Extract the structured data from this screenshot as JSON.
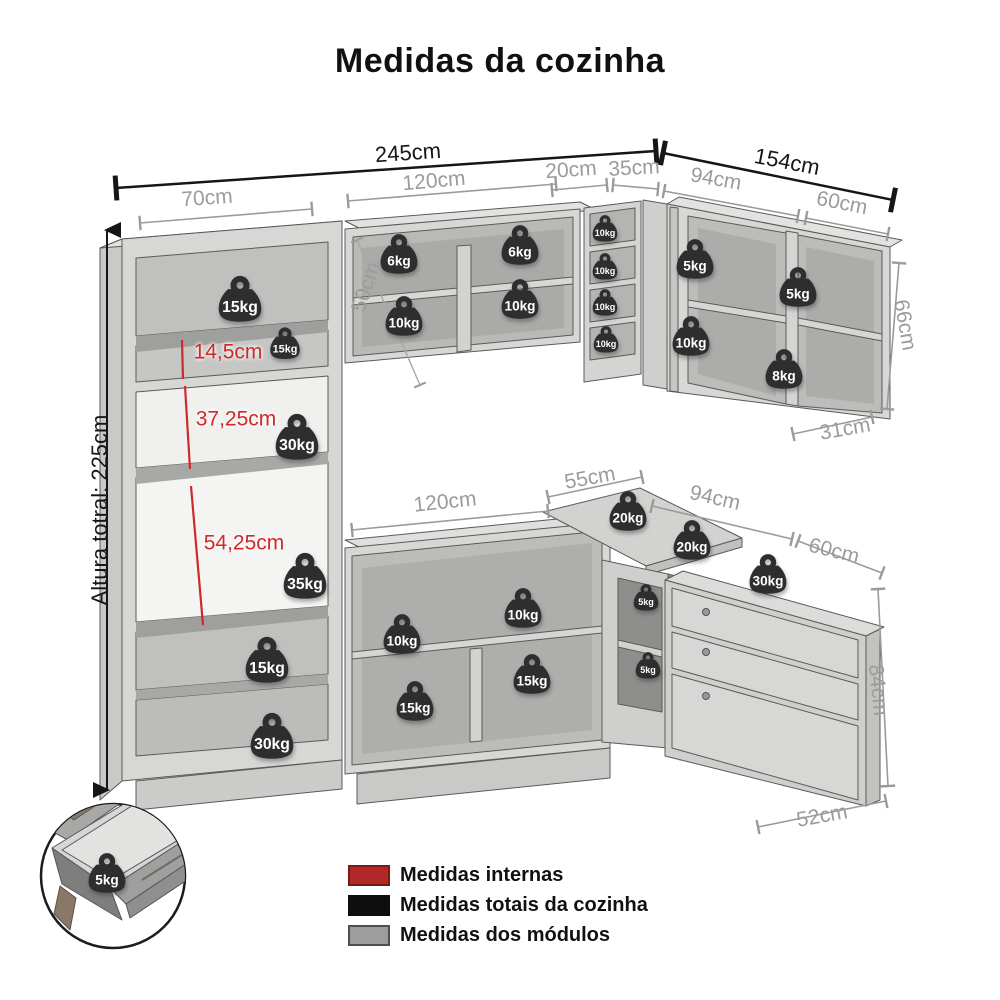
{
  "title": "Medidas da cozinha",
  "legend": {
    "items": [
      {
        "label": "Medidas internas",
        "color": "#b22828",
        "border": "#7a1818"
      },
      {
        "label": "Medidas totais da cozinha",
        "color": "#0e0e0e",
        "border": "#0e0e0e"
      },
      {
        "label": "Medidas dos módulos",
        "color": "#9d9d9d",
        "border": "#4f4f4f"
      }
    ]
  },
  "colors": {
    "dim_total": "#161616",
    "dim_module": "#9b9c99",
    "dim_internal": "#cf2a2a",
    "weight_badge": "#2e2e2e",
    "weight_text": "#ffffff",
    "cabinet_light": "#d7d8d5",
    "cabinet_shadow": "#aeafac"
  },
  "dimension_labels": [
    {
      "text": "245cm",
      "x": 408,
      "y": 153,
      "rot": -4,
      "t": "total"
    },
    {
      "text": "154cm",
      "x": 787,
      "y": 162,
      "rot": 11,
      "t": "total"
    },
    {
      "text": "Altura totral: 225cm",
      "x": 100,
      "y": 510,
      "rot": -90,
      "t": "total"
    },
    {
      "text": "70cm",
      "x": 207,
      "y": 198,
      "rot": -4,
      "t": "module"
    },
    {
      "text": "120cm",
      "x": 434,
      "y": 181,
      "rot": -5,
      "t": "module"
    },
    {
      "text": "20cm",
      "x": 571,
      "y": 170,
      "rot": -4,
      "t": "module"
    },
    {
      "text": "35cm",
      "x": 634,
      "y": 168,
      "rot": -3,
      "t": "module"
    },
    {
      "text": "94cm",
      "x": 716,
      "y": 179,
      "rot": 10,
      "t": "module"
    },
    {
      "text": "60cm",
      "x": 842,
      "y": 203,
      "rot": 11,
      "t": "module"
    },
    {
      "text": "66cm",
      "x": 905,
      "y": 325,
      "rot": 80,
      "t": "module"
    },
    {
      "text": "31cm",
      "x": 845,
      "y": 429,
      "rot": -10,
      "t": "module"
    },
    {
      "text": "50cm",
      "x": 366,
      "y": 287,
      "rot": -72,
      "t": "module"
    },
    {
      "text": "14,5cm",
      "x": 228,
      "y": 352,
      "rot": 0,
      "t": "internal"
    },
    {
      "text": "37,25cm",
      "x": 236,
      "y": 419,
      "rot": 0,
      "t": "internal"
    },
    {
      "text": "54,25cm",
      "x": 244,
      "y": 543,
      "rot": 0,
      "t": "internal"
    },
    {
      "text": "55cm",
      "x": 590,
      "y": 478,
      "rot": -10,
      "t": "module"
    },
    {
      "text": "120cm",
      "x": 445,
      "y": 502,
      "rot": -6,
      "t": "module"
    },
    {
      "text": "94cm",
      "x": 715,
      "y": 498,
      "rot": 13,
      "t": "module"
    },
    {
      "text": "60cm",
      "x": 834,
      "y": 551,
      "rot": 14,
      "t": "module"
    },
    {
      "text": "84cm",
      "x": 878,
      "y": 690,
      "rot": 84,
      "t": "module"
    },
    {
      "text": "52cm",
      "x": 822,
      "y": 816,
      "rot": -10,
      "t": "module"
    }
  ],
  "weights": [
    {
      "label": "15kg",
      "x": 240,
      "y": 300,
      "s": "l"
    },
    {
      "label": "15kg",
      "x": 285,
      "y": 344,
      "s": "s"
    },
    {
      "label": "30kg",
      "x": 297,
      "y": 438,
      "s": "l"
    },
    {
      "label": "35kg",
      "x": 305,
      "y": 577,
      "s": "l"
    },
    {
      "label": "15kg",
      "x": 267,
      "y": 661,
      "s": "l"
    },
    {
      "label": "30kg",
      "x": 272,
      "y": 737,
      "s": "l"
    },
    {
      "label": "6kg",
      "x": 399,
      "y": 255,
      "s": "m"
    },
    {
      "label": "10kg",
      "x": 404,
      "y": 317,
      "s": "m"
    },
    {
      "label": "6kg",
      "x": 520,
      "y": 246,
      "s": "m"
    },
    {
      "label": "10kg",
      "x": 520,
      "y": 300,
      "s": "m"
    },
    {
      "label": "10kg",
      "x": 605,
      "y": 229,
      "s": "xs"
    },
    {
      "label": "10kg",
      "x": 605,
      "y": 267,
      "s": "xs"
    },
    {
      "label": "10kg",
      "x": 605,
      "y": 303,
      "s": "xs"
    },
    {
      "label": "10kg",
      "x": 606,
      "y": 340,
      "s": "xs"
    },
    {
      "label": "5kg",
      "x": 695,
      "y": 260,
      "s": "m"
    },
    {
      "label": "10kg",
      "x": 691,
      "y": 337,
      "s": "m"
    },
    {
      "label": "5kg",
      "x": 798,
      "y": 288,
      "s": "m"
    },
    {
      "label": "8kg",
      "x": 784,
      "y": 370,
      "s": "m"
    },
    {
      "label": "20kg",
      "x": 628,
      "y": 512,
      "s": "m"
    },
    {
      "label": "20kg",
      "x": 692,
      "y": 541,
      "s": "m"
    },
    {
      "label": "30kg",
      "x": 768,
      "y": 575,
      "s": "m"
    },
    {
      "label": "10kg",
      "x": 402,
      "y": 635,
      "s": "m"
    },
    {
      "label": "10kg",
      "x": 523,
      "y": 609,
      "s": "m"
    },
    {
      "label": "15kg",
      "x": 415,
      "y": 702,
      "s": "m"
    },
    {
      "label": "15kg",
      "x": 532,
      "y": 675,
      "s": "m"
    },
    {
      "label": "5kg",
      "x": 646,
      "y": 598,
      "s": "xs"
    },
    {
      "label": "5kg",
      "x": 648,
      "y": 666,
      "s": "xs"
    },
    {
      "label": "5kg",
      "x": 107,
      "y": 874,
      "s": "m"
    }
  ]
}
